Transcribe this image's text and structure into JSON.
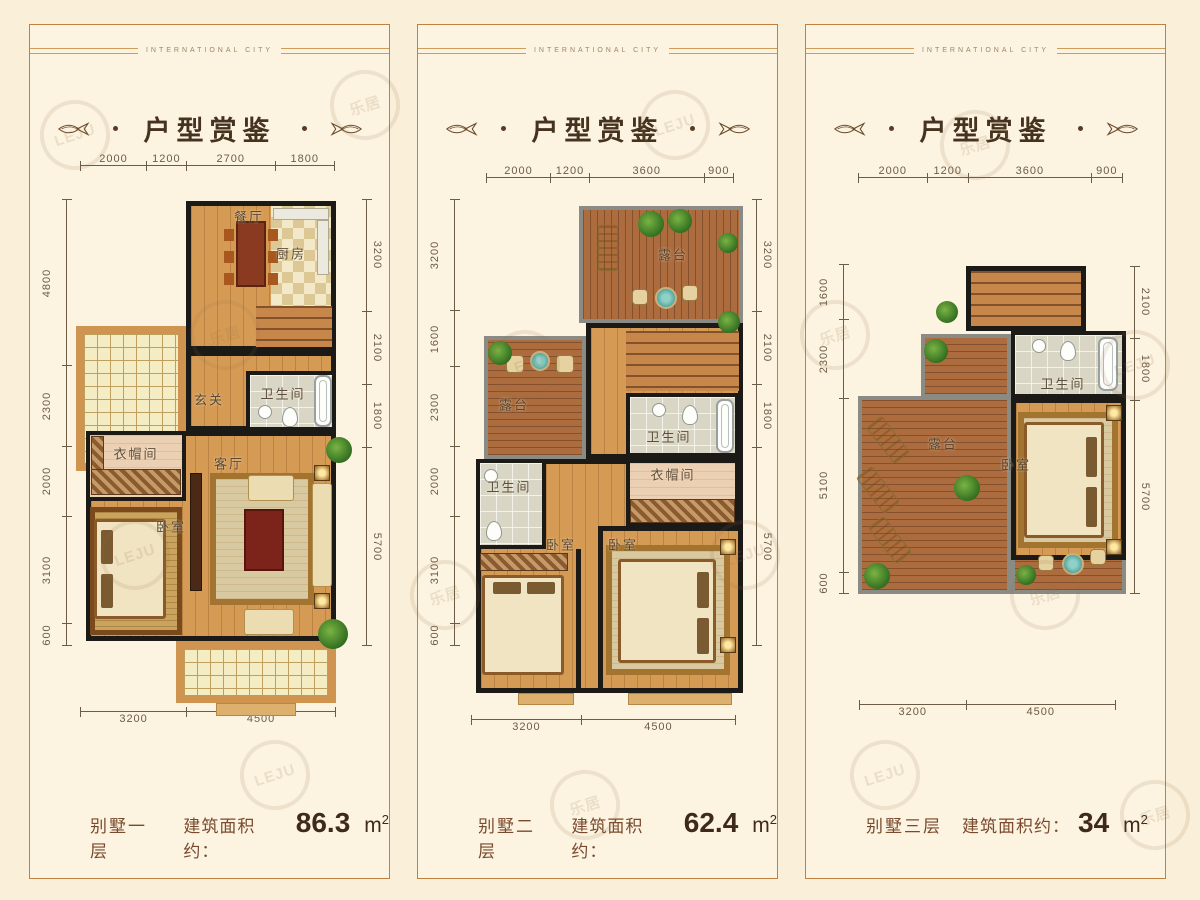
{
  "watermark": {
    "logo": "LEJU",
    "cn": "乐居"
  },
  "panels": [
    {
      "header": "INTERNATIONAL CITY",
      "title": "户型赏鉴",
      "dims": {
        "top": [
          "2000",
          "1200",
          "2700",
          "1800"
        ],
        "left": [
          "4800",
          "2300",
          "2000",
          "3100",
          "600"
        ],
        "right": [
          "3200",
          "2100",
          "1800",
          "5700"
        ],
        "bottom": [
          "3200",
          "4500"
        ]
      },
      "rooms": {
        "dining": "餐厅",
        "kitchen": "厨房",
        "bath": "卫生间",
        "foyer": "玄关",
        "cloak": "衣帽间",
        "living": "客厅",
        "bedroom": "卧室"
      },
      "caption": {
        "floor": "别墅一层",
        "area_label": "建筑面积约：",
        "value": "86.3",
        "unit": "m",
        "unit_sup": "2"
      }
    },
    {
      "header": "INTERNATIONAL CITY",
      "title": "户型赏鉴",
      "dims": {
        "top": [
          "2000",
          "1200",
          "3600",
          "900"
        ],
        "left": [
          "3200",
          "1600",
          "2300",
          "2000",
          "3100",
          "600"
        ],
        "right": [
          "3200",
          "2100",
          "1800",
          "5700"
        ],
        "bottom": [
          "3200",
          "4500"
        ]
      },
      "rooms": {
        "terrace_top": "露台",
        "terrace_left": "露台",
        "bath_right": "卫生间",
        "bath_left": "卫生间",
        "cloak": "衣帽间",
        "bedroom_left": "卧室",
        "bedroom_right": "卧室"
      },
      "caption": {
        "floor": "别墅二层",
        "area_label": "建筑面积约：",
        "value": "62.4",
        "unit": "m",
        "unit_sup": "2"
      }
    },
    {
      "header": "INTERNATIONAL CITY",
      "title": "户型赏鉴",
      "dims": {
        "top": [
          "2000",
          "1200",
          "3600",
          "900"
        ],
        "left": [
          "1600",
          "2300",
          "5100",
          "600"
        ],
        "right": [
          "2100",
          "1800",
          "5700"
        ],
        "bottom": [
          "3200",
          "4500"
        ]
      },
      "rooms": {
        "bath": "卫生间",
        "terrace": "露台",
        "bedroom": "卧室"
      },
      "caption": {
        "floor": "别墅三层",
        "area_label": "建筑面积约：",
        "value": "34",
        "unit": "m",
        "unit_sup": "2"
      }
    }
  ]
}
